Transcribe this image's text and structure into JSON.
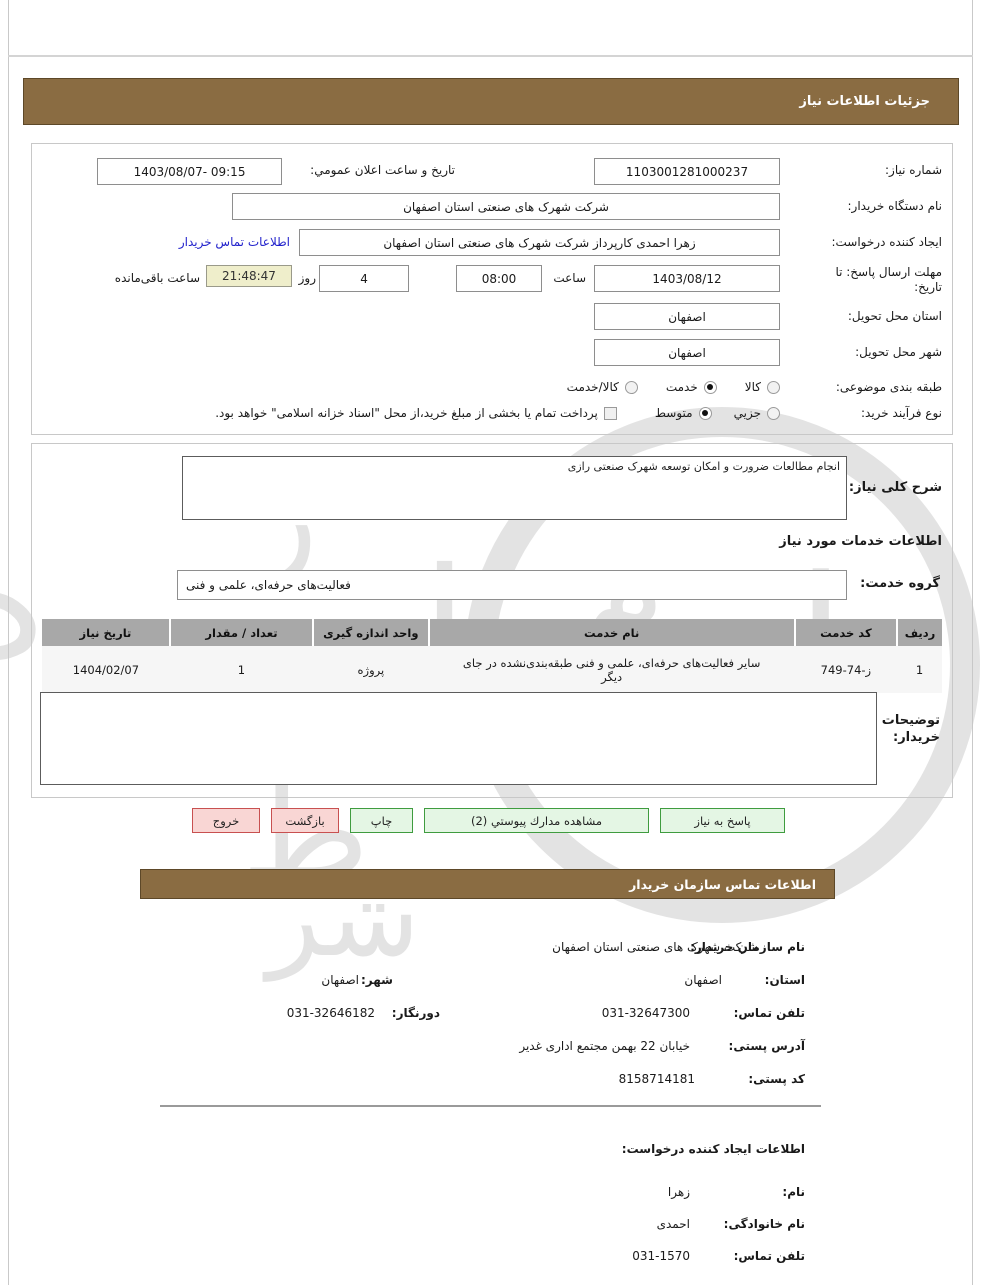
{
  "colors": {
    "accent_brown": "#8a6c42",
    "link_blue": "#2222cc",
    "btn_green_bg": "#e4f6e4",
    "btn_green_border": "#3f9c3f",
    "btn_pink_bg": "#f9d6d4",
    "btn_pink_border": "#c85050",
    "timer_bg": "#efeecb",
    "table_header_bg": "#a8a8a8"
  },
  "header1": {
    "title": "جزئیات اطلاعات نیاز"
  },
  "details": {
    "need_no_label": "شماره نیاز:",
    "need_no": "1103001281000237",
    "announce_label": "تاریخ و ساعت اعلان عمومي:",
    "announce_value": "1403/08/07- 09:15",
    "buyer_org_label": "نام دستگاه خریدار:",
    "buyer_org": "شرکت شهرک های صنعتی استان اصفهان",
    "creator_label": "ایجاد کننده درخواست:",
    "creator": "زهرا احمدی کارپرداز شرکت شهرک های صنعتی استان اصفهان",
    "contact_link": "اطلاعات تماس خریدار",
    "deadline_label": "مهلت ارسال پاسخ: تا تاریخ:",
    "deadline_date": "1403/08/12",
    "hour_label": "ساعت",
    "deadline_time": "08:00",
    "days_value": "4",
    "days_label": "روز",
    "timer": "21:48:47",
    "remaining_label": "ساعت باقی‌مانده",
    "province_label": "استان محل تحویل:",
    "province": "اصفهان",
    "city_label": "شهر محل تحویل:",
    "city": "اصفهان",
    "subject_label": "طبقه بندی موضوعی:",
    "subject_options": [
      {
        "label": "کالا",
        "checked": false
      },
      {
        "label": "خدمت",
        "checked": true
      },
      {
        "label": "کالا/خدمت",
        "checked": false
      }
    ],
    "process_label": "نوع فرآیند خرید:",
    "process_options": [
      {
        "label": "جزیي",
        "checked": false
      },
      {
        "label": "متوسط",
        "checked": true
      }
    ],
    "treasury_checkbox_label": "پرداخت تمام یا بخشی از مبلغ خرید،از محل \"اسناد خزانه اسلامی\" خواهد بود.",
    "treasury_checked": false
  },
  "need_desc": {
    "label": "شرح کلی نیاز:",
    "value": "انجام مطالعات ضرورت و امکان توسعه شهرک صنعتی رازی",
    "services_heading": "اطلاعات خدمات مورد نیاز",
    "group_label": "گروه خدمت:",
    "group_value": "فعالیت‌های حرفه‌ای، علمی و فنی"
  },
  "table": {
    "headers": [
      "ردیف",
      "کد خدمت",
      "نام خدمت",
      "واحد اندازه گیری",
      "تعداد / مقدار",
      "تاریخ نیاز"
    ],
    "rows": [
      [
        "1",
        "ز-74-749",
        "سایر فعالیت‌های حرفه‌ای، علمی و فنی طبقه‌بندی‌نشده در جای دیگر",
        "پروژه",
        "1",
        "1404/02/07"
      ]
    ]
  },
  "buyer_notes": {
    "label": "توضیحات خریدار:",
    "value": ""
  },
  "buttons": {
    "respond": "پاسخ به نیاز",
    "view_docs": "مشاهده مدارك پیوستي (2)",
    "print": "چاپ",
    "back": "بازگشت",
    "exit": "خروج"
  },
  "header2": {
    "title": "اطلاعات تماس سازمان خریدار"
  },
  "contact": {
    "org_label": "نام سازمان خریدار:",
    "org": "شرکت شهرک های صنعتی استان اصفهان",
    "province_label": "استان:",
    "province": "اصفهان",
    "city_label": "شهر:",
    "city": "اصفهان",
    "phone_label": "تلفن تماس:",
    "phone": "031-32647300",
    "fax_label": "دورنگار:",
    "fax": "031-32646182",
    "address_label": "آدرس پستی:",
    "address": "خیابان 22 بهمن مجتمع اداری غدیر",
    "postal_label": "کد پستی:",
    "postal": "8158714181"
  },
  "creator_info": {
    "heading": "اطلاعات ایجاد کننده درخواست:",
    "name_label": "نام:",
    "name": "زهرا",
    "family_label": "نام خانوادگی:",
    "family": "احمدی",
    "phone_label": "تلفن تماس:",
    "phone": "031-1570"
  }
}
